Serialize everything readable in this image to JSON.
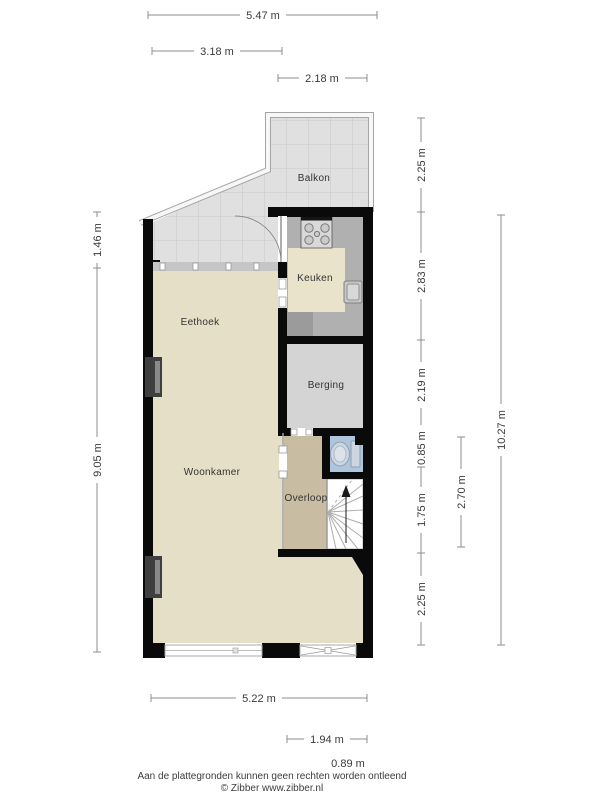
{
  "rooms": {
    "balkon": "Balkon",
    "keuken": "Keuken",
    "eethoek": "Eethoek",
    "berging": "Berging",
    "woonkamer": "Woonkamer",
    "overloop": "Overloop"
  },
  "dimensions": {
    "top": [
      "5.47 m",
      "3.18 m",
      "2.18 m"
    ],
    "left": [
      "1.46 m",
      "9.05 m"
    ],
    "right": [
      "2.25 m",
      "2.83 m",
      "2.19 m",
      "0.85 m",
      "1.75 m",
      "2.25 m",
      "2.70 m",
      "10.27 m"
    ],
    "bottom": [
      "5.22 m",
      "1.94 m",
      "0.89 m"
    ]
  },
  "footer": {
    "line1": "Aan de plattegronden kunnen geen rechten worden ontleend",
    "line2": "© Zibber www.zibber.nl"
  },
  "colors": {
    "wall": "#0a0a0a",
    "floor_living": "#e6dfc8",
    "floor_overloop": "#c8bca2",
    "floor_kitchen": "#b0b0b0",
    "floor_berging": "#d4d4d4",
    "floor_toilet": "#aec5dc",
    "tile": "#e0e0e0",
    "tile_line": "#c9c9c9",
    "counter": "#eae3cb",
    "dim_line": "#8c8c8c"
  }
}
